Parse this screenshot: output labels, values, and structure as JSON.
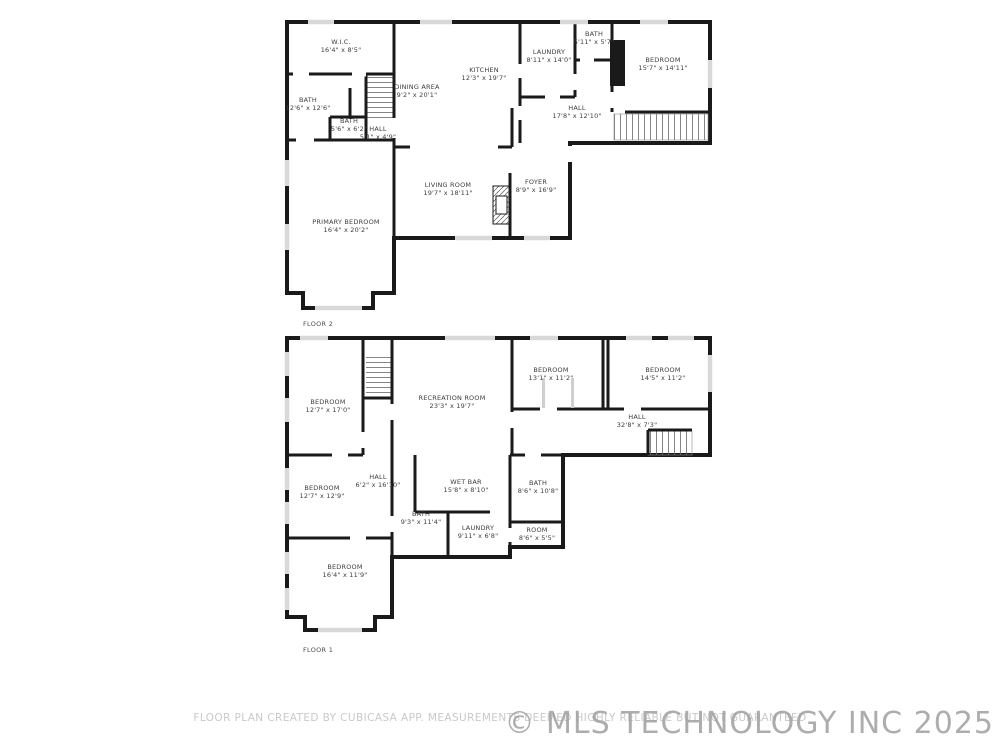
{
  "footer": {
    "disclaimer": "FLOOR PLAN CREATED BY CUBICASA APP. MEASUREMENTS DEEMED HIGHLY RELIABLE BUT NOT GUARANTEED",
    "watermark": "© MLS TECHNOLOGY INC 2025"
  },
  "colors": {
    "wall": "#1a1a1a",
    "window": "#d9d9d9",
    "label_text": "#3d3d3d",
    "disclaimer_text": "#c9c9c9",
    "watermark_text": "#9f9f9f"
  },
  "floors": [
    {
      "label": "FLOOR 2",
      "rooms": [
        {
          "name": "W.I.C.",
          "dims": "16'4\" x 8'5\""
        },
        {
          "name": "BATH",
          "dims": "12'6\" x 12'6\""
        },
        {
          "name": "BATH",
          "dims": "5'6\" x 6'2\""
        },
        {
          "name": "HALL",
          "dims": "5'1\" x 4'9\""
        },
        {
          "name": "DINING AREA",
          "dims": "9'2\" x 20'1\""
        },
        {
          "name": "KITCHEN",
          "dims": "12'3\" x 19'7\""
        },
        {
          "name": "LAUNDRY",
          "dims": "8'11\" x 14'0\""
        },
        {
          "name": "BATH",
          "dims": "5'11\" x 5'7\""
        },
        {
          "name": "BEDROOM",
          "dims": "15'7\" x 14'11\""
        },
        {
          "name": "HALL",
          "dims": "17'8\" x 12'10\""
        },
        {
          "name": "LIVING ROOM",
          "dims": "19'7\" x 18'11\""
        },
        {
          "name": "FOYER",
          "dims": "8'9\" x 16'9\""
        },
        {
          "name": "PRIMARY BEDROOM",
          "dims": "16'4\" x 20'2\""
        }
      ]
    },
    {
      "label": "FLOOR 1",
      "rooms": [
        {
          "name": "BEDROOM",
          "dims": "12'7\" x 17'0\""
        },
        {
          "name": "RECREATION ROOM",
          "dims": "23'3\" x 19'7\""
        },
        {
          "name": "BEDROOM",
          "dims": "13'1\" x 11'2\""
        },
        {
          "name": "BEDROOM",
          "dims": "14'5\" x 11'2\""
        },
        {
          "name": "HALL",
          "dims": "32'8\" x 7'3\""
        },
        {
          "name": "BEDROOM",
          "dims": "12'7\" x 12'9\""
        },
        {
          "name": "HALL",
          "dims": "6'2\" x 16'10\""
        },
        {
          "name": "WET BAR",
          "dims": "15'8\" x 8'10\""
        },
        {
          "name": "BATH",
          "dims": "8'6\" x 10'8\""
        },
        {
          "name": "BATH",
          "dims": "9'3\" x 11'4\""
        },
        {
          "name": "LAUNDRY",
          "dims": "9'11\" x 6'8\""
        },
        {
          "name": "ROOM",
          "dims": "8'6\" x 5'5\""
        },
        {
          "name": "BEDROOM",
          "dims": "16'4\" x 11'9\""
        }
      ]
    }
  ]
}
